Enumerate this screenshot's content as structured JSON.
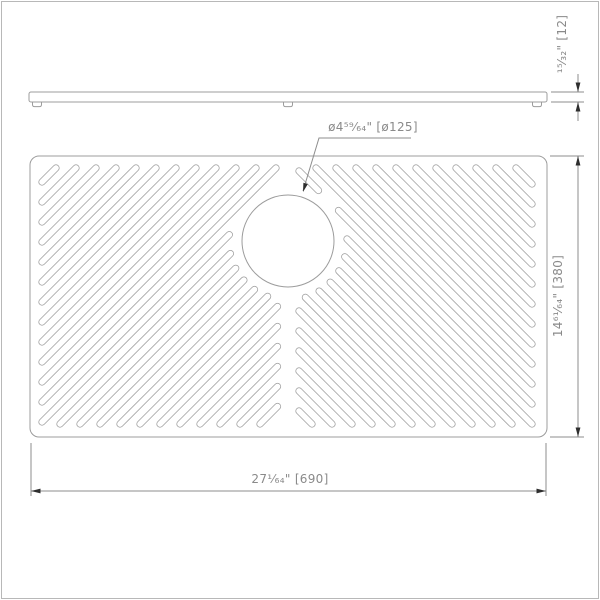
{
  "labels": {
    "hole_diameter": "ø4⁵⁹⁄₆₄\"  [ø125]",
    "thickness": "¹⁵⁄₃₂\"  [12]",
    "height": "14⁶¹⁄₆₄\"  [380]",
    "width": "27¹⁄₆₄\"  [690]"
  },
  "colors": {
    "outline": "#9c9c9c",
    "dim_line": "#8d8d8d",
    "arrow": "#2e2e2e",
    "text": "#8a8a8a",
    "frame": "#b8b8b8",
    "background": "#ffffff"
  },
  "drawing": {
    "side_view": {
      "bar": {
        "x": 29,
        "y": 92,
        "w": 518,
        "h": 10
      },
      "feet_x": [
        37,
        288,
        537
      ]
    },
    "plan_view": {
      "rect": {
        "x": 30,
        "y": 156,
        "w": 517,
        "h": 281,
        "r": 9
      },
      "circle": {
        "cx": 288,
        "cy": 241,
        "r": 46
      },
      "slots": {
        "step": 20,
        "hole_clear_r": 59,
        "left": {
          "x0": 42,
          "x1": 277.5,
          "y0": 168,
          "y1": 424,
          "k_start": 224,
          "k_end": 700
        },
        "right": {
          "x0": 299,
          "x1": 532,
          "y0": 168,
          "y1": 424,
          "k_start": -132,
          "k_end": 368
        }
      }
    }
  }
}
